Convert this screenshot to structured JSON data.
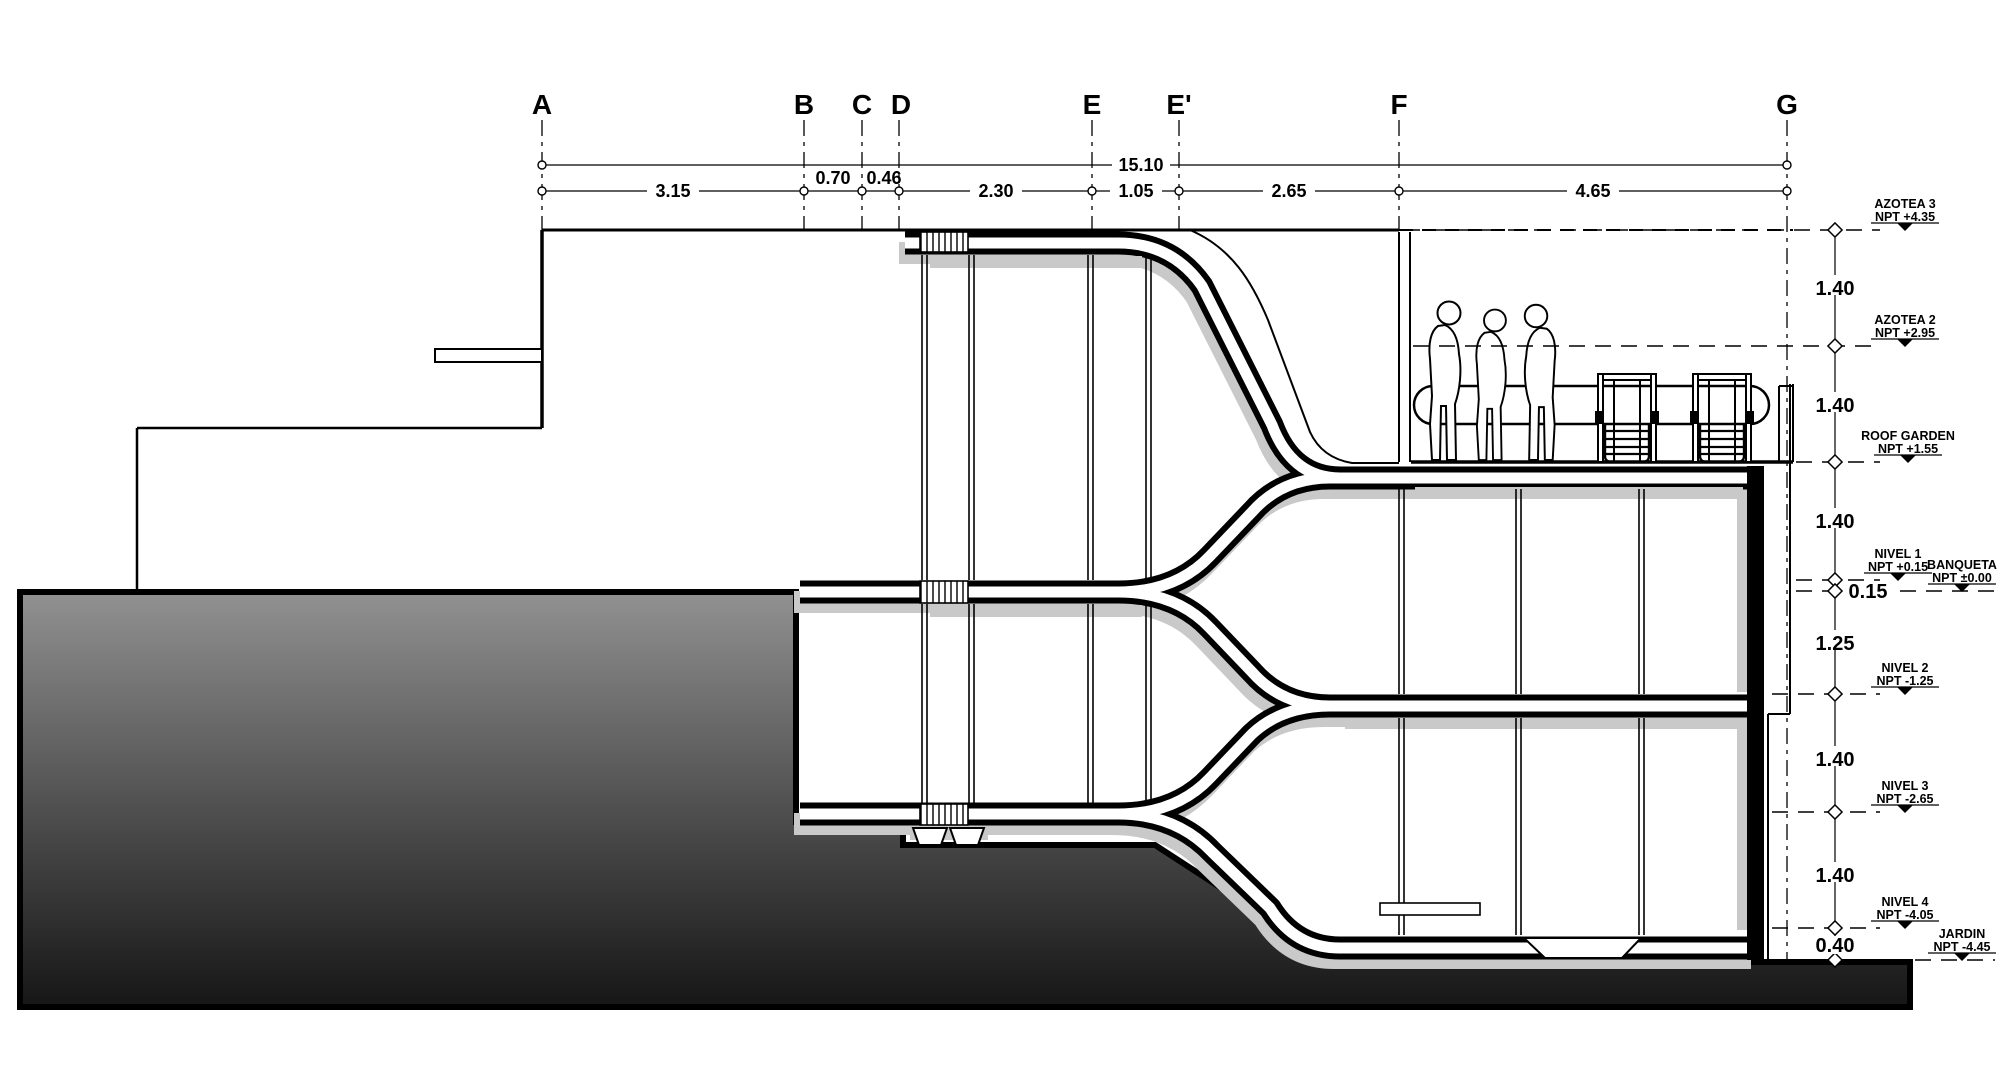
{
  "drawing": {
    "type": "architectural-section",
    "overall_dimension": "15.10",
    "small_gap_dimension": "0.15"
  },
  "grid": {
    "labels": [
      {
        "id": "A"
      },
      {
        "id": "B"
      },
      {
        "id": "C"
      },
      {
        "id": "D"
      },
      {
        "id": "E"
      },
      {
        "id": "E'"
      },
      {
        "id": "F"
      },
      {
        "id": "G"
      }
    ]
  },
  "dimensions": {
    "segments": [
      "3.15",
      "0.70",
      "0.46",
      "2.30",
      "1.05",
      "2.65",
      "4.65"
    ]
  },
  "levels": [
    {
      "name": "AZOTEA 3",
      "npt": "NPT +4.35"
    },
    {
      "name": "AZOTEA 2",
      "npt": "NPT +2.95"
    },
    {
      "name": "ROOF GARDEN",
      "npt": "NPT +1.55"
    },
    {
      "name": "NIVEL 1",
      "npt": "NPT +0.15"
    },
    {
      "name": "BANQUETA",
      "npt": "NPT ±0.00"
    },
    {
      "name": "NIVEL 2",
      "npt": "NPT -1.25"
    },
    {
      "name": "NIVEL 3",
      "npt": "NPT -2.65"
    },
    {
      "name": "NIVEL 4",
      "npt": "NPT -4.05"
    },
    {
      "name": "JARDIN",
      "npt": "NPT -4.45"
    }
  ],
  "level_spacings": [
    "1.40",
    "1.40",
    "1.40",
    "0.15",
    "1.25",
    "1.40",
    "1.40",
    "0.40"
  ],
  "colors": {
    "line": "#000000",
    "shadow": "#c9c9c9",
    "terrain_top": "#919191",
    "terrain_bottom": "#161616"
  }
}
